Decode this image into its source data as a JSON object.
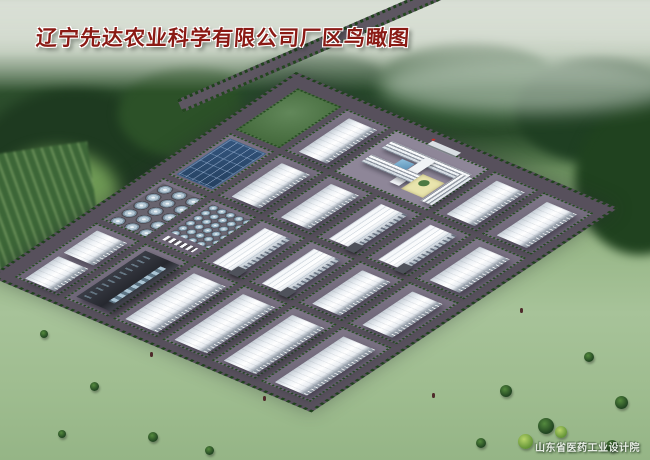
{
  "title": "辽宁先达农业科学有限公司厂区鸟瞰图",
  "credit": "山东省医药工业设计院",
  "scene": {
    "description": "bird's-eye architectural rendering of a factory campus",
    "palette": {
      "title_red": "#8a1a14",
      "road_gray": "#57505c",
      "paving": "#746b7e",
      "building_white": "#f5f8fb",
      "solar_blue": "#2d4a71",
      "tank_steel": "#b6c9d6",
      "grass_light": "#a3c096",
      "forest_dark": "#23441f",
      "courtyard_yellow": "#e9e4ad"
    }
  }
}
